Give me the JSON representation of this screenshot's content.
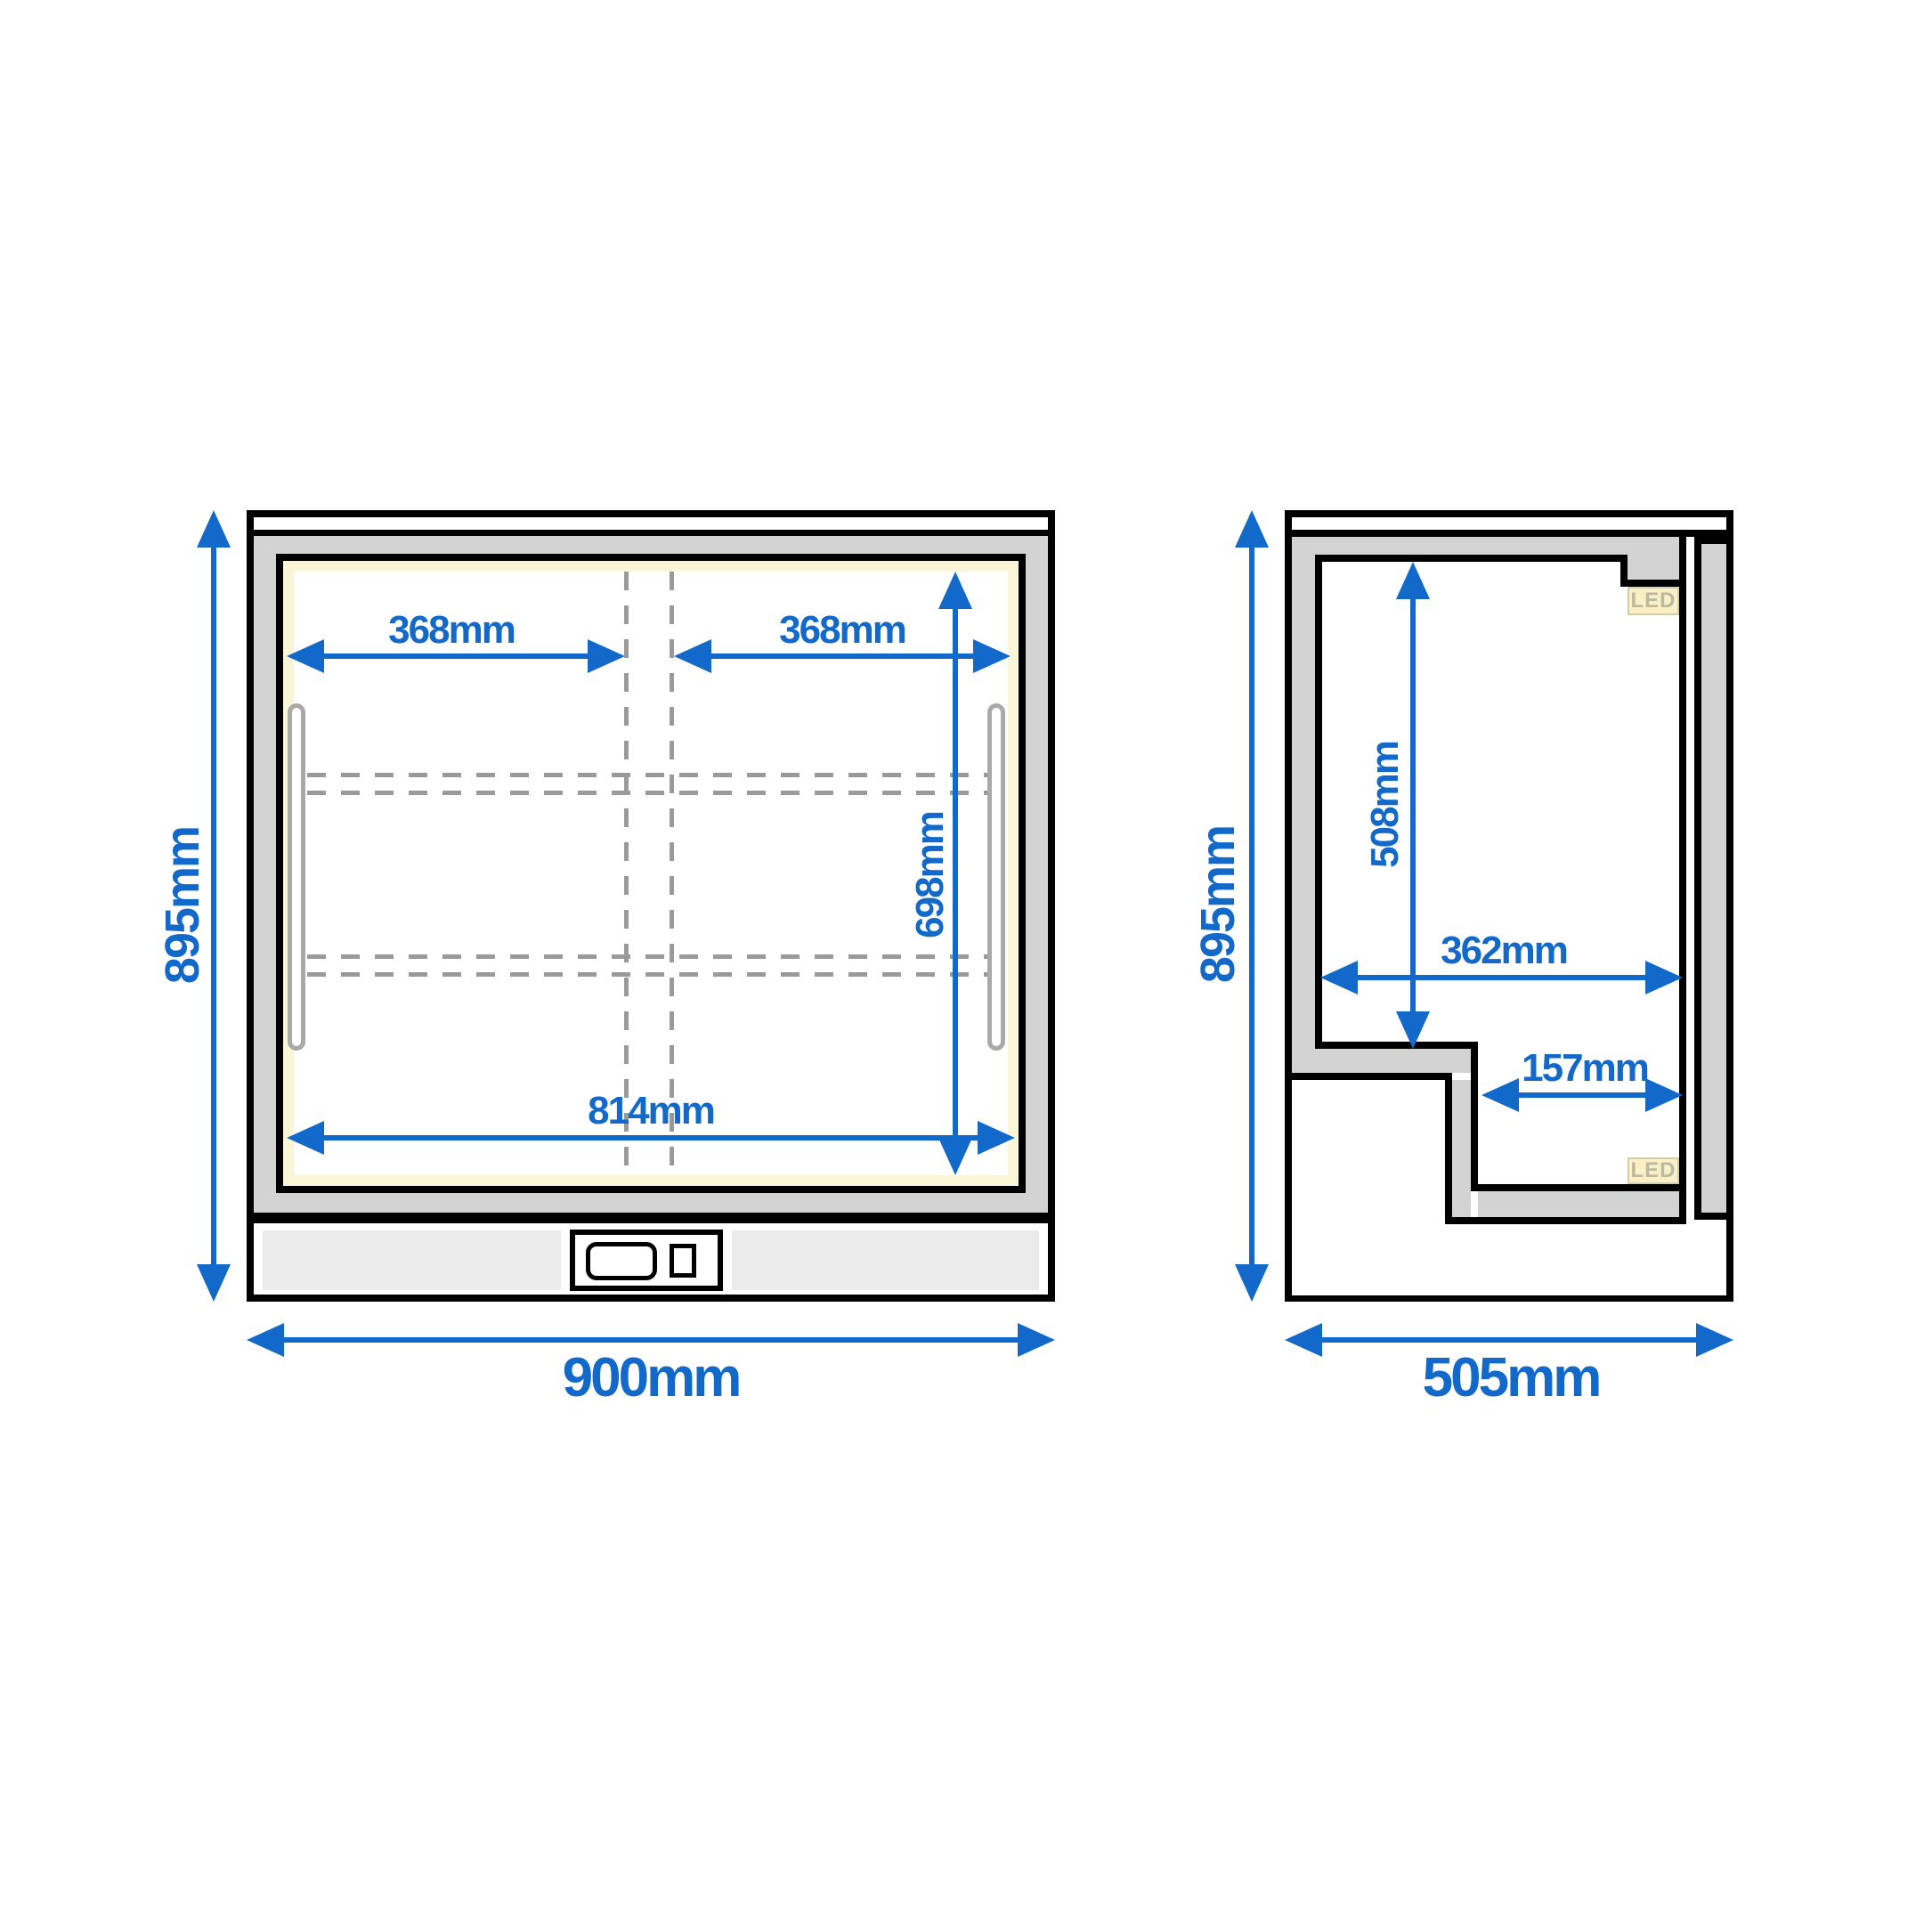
{
  "colors": {
    "accent": "#1269c9",
    "frame-gray": "#d3d3d3",
    "dash": "#9a9a9a",
    "handle": "#a9a9a9",
    "cream": "#fbf5d8",
    "led-bg": "#faf0c4",
    "led-border": "#cfcfaf",
    "led-text": "#b9b9a4",
    "plinth-strip": "#ebebeb",
    "ink": "#000000",
    "bg": "#ffffff"
  },
  "front_view": {
    "name": "front-view",
    "dims": {
      "overall_height": {
        "label": "895mm"
      },
      "overall_width": {
        "label": "900mm"
      },
      "shelf_left_width": {
        "label": "368mm"
      },
      "shelf_right_width": {
        "label": "368mm"
      },
      "interior_height": {
        "label": "698mm"
      },
      "interior_width": {
        "label": "814mm"
      }
    }
  },
  "side_view": {
    "name": "side-view",
    "dims": {
      "overall_height": {
        "label": "895mm"
      },
      "overall_depth": {
        "label": "505mm"
      },
      "chamber_height": {
        "label": "508mm"
      },
      "chamber_depth": {
        "label": "362mm"
      },
      "recess_depth": {
        "label": "157mm"
      }
    },
    "led_top": "LED",
    "led_bottom": "LED"
  }
}
